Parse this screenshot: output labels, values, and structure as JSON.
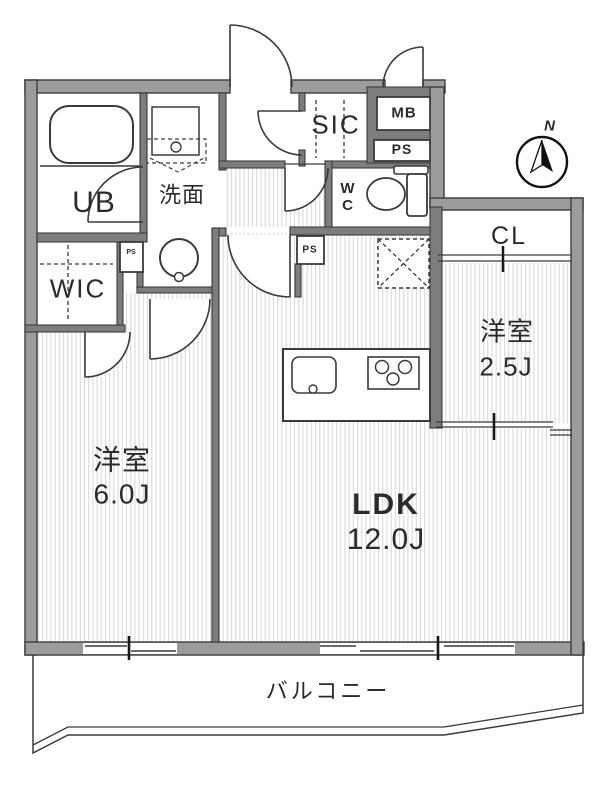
{
  "plan": {
    "rooms": {
      "bedroom_main": {
        "name": "洋室",
        "size": "6.0J"
      },
      "ldk": {
        "name": "LDK",
        "size": "12.0J"
      },
      "bedroom_small": {
        "name": "洋室",
        "size": "2.5J"
      },
      "unit_bath": "UB",
      "washroom": "洗面",
      "walk_in_closet": "WIC",
      "shoe_closet": "SIC",
      "toilet": "W\nC",
      "closet": "CL",
      "balcony": "バルコニー"
    },
    "utilities": {
      "meter_box": "MB",
      "pipe_space_entry": "PS",
      "pipe_space_hall": "PS",
      "pipe_space_wic": "PS"
    },
    "compass_north": "N",
    "colors": {
      "wall_fill": "#9c9c9c",
      "interior_wall_fill": "#7d7d7d",
      "line": "#3a3a3a",
      "floor_stripe": "#d9d9dd",
      "background": "#ffffff"
    }
  }
}
